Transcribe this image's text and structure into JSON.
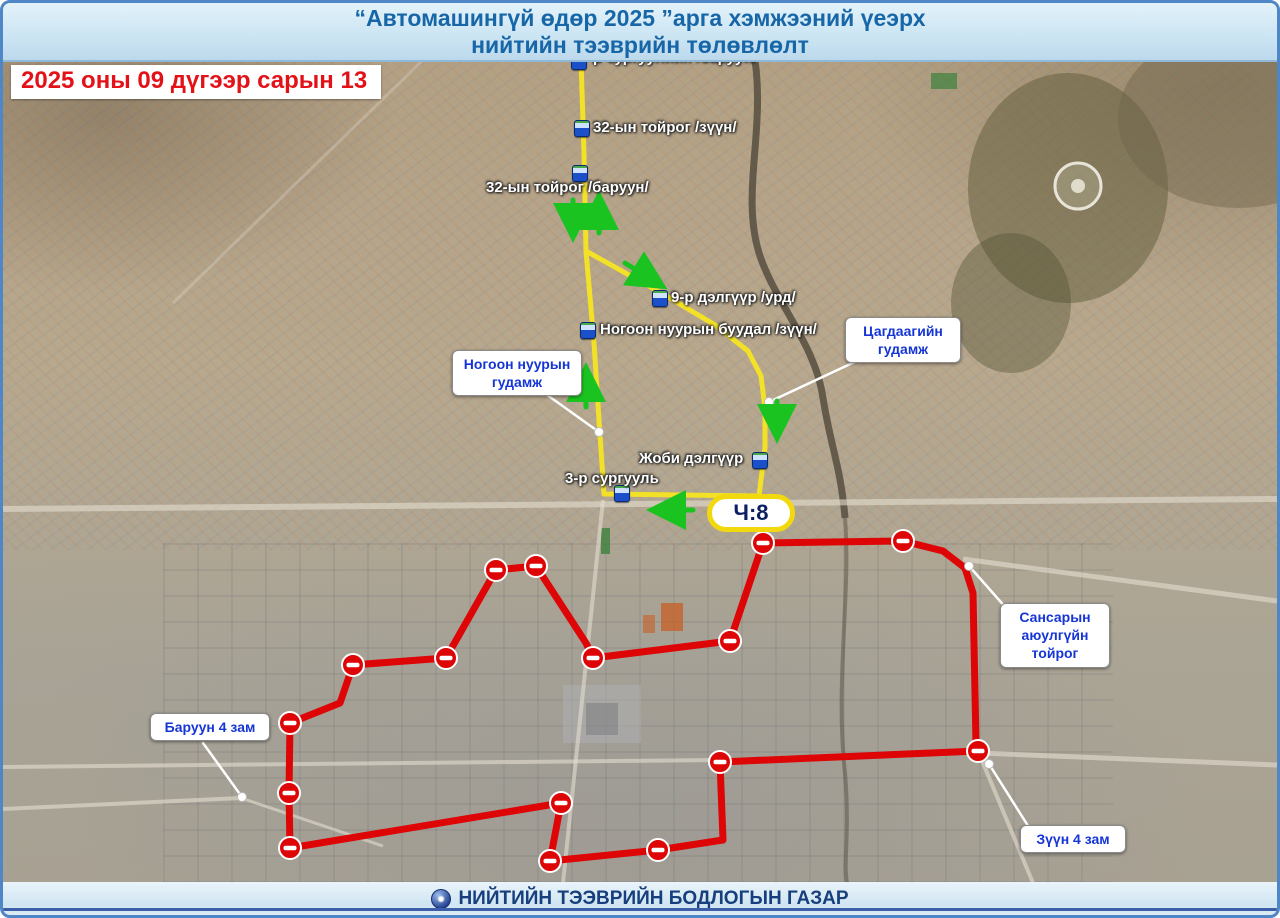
{
  "header": {
    "title_line1": "“Автомашингүй өдөр 2025 ”арга хэмжээний үеэрх",
    "title_line2": "нийтийн тээврийн төлөвлөлт"
  },
  "date_badge": "2025 оны 09 дүгээр сарын 13",
  "footer": {
    "org": "НИЙТИЙН ТЭЭВРИЙН БОДЛОГЫН ГАЗАР",
    "logo": "public-transport-authority-emblem"
  },
  "colors": {
    "yellow_route": "#f2e126",
    "red_route": "#dd0505",
    "arrow_green": "#1bc320",
    "callout_text": "#1535d6",
    "stop_label_text": "#ffffff",
    "header_text": "#1766a8",
    "date_text": "#e31219",
    "footer_text": "#173f7d",
    "badge_border": "#f2d90e",
    "badge_text": "#0b1f63"
  },
  "map": {
    "route_badge": {
      "text": "Ч:8"
    },
    "stops": [
      {
        "label": "-р сургуулийн /баруун/"
      },
      {
        "label": "32-ын тойрог /зүүн/"
      },
      {
        "label": "32-ын тойрог /баруун/"
      },
      {
        "label": "9-р дэлгүүр /урд/"
      },
      {
        "label": "Ногоон нуурын буудал /зүүн/"
      },
      {
        "label": "Жоби дэлгүүр"
      },
      {
        "label": "3-р сургууль"
      }
    ],
    "callouts": [
      {
        "id": "tsagdaagiin-gudamj",
        "lines": [
          "Цагдаагийн",
          "гудамж"
        ],
        "leader": [
          [
            858,
            356
          ],
          [
            766,
            399
          ]
        ]
      },
      {
        "id": "nogoon-nuuryn-gudamj",
        "lines": [
          "Ногоон нуурын",
          "гудамж"
        ],
        "leader": [
          [
            540,
            389
          ],
          [
            596,
            429
          ]
        ]
      },
      {
        "id": "sansaryn-toirog",
        "lines": [
          "Сансарын",
          "аюулгүйн",
          "тойрог"
        ],
        "leader": [
          [
            1004,
            606
          ],
          [
            966,
            563
          ]
        ]
      },
      {
        "id": "baruun-4-zam",
        "lines": [
          "Баруун 4 зам"
        ],
        "leader": [
          [
            200,
            740
          ],
          [
            239,
            794
          ]
        ]
      },
      {
        "id": "zuun-4-zam",
        "lines": [
          "Зүүн 4 зам"
        ],
        "leader": [
          [
            1027,
            826
          ],
          [
            986,
            761
          ]
        ]
      }
    ],
    "routes": {
      "yellow": {
        "name": "bus-route-Ч8",
        "paths": [
          [
            [
              578,
              57
            ],
            [
              581,
              150
            ],
            [
              583,
              248
            ],
            [
              591,
              340
            ],
            [
              597,
              432
            ],
            [
              601,
              491
            ],
            [
              756,
              493
            ]
          ],
          [
            [
              583,
              248
            ],
            [
              660,
              291
            ],
            [
              712,
              322
            ],
            [
              745,
              348
            ],
            [
              758,
              373
            ],
            [
              762,
              405
            ],
            [
              762,
              445
            ],
            [
              756,
              493
            ]
          ]
        ]
      },
      "red": {
        "name": "road-closure-perimeter",
        "points": [
          [
            493,
            567
          ],
          [
            533,
            563
          ],
          [
            583,
            640
          ],
          [
            590,
            655
          ],
          [
            727,
            638
          ],
          [
            760,
            540
          ],
          [
            900,
            538
          ],
          [
            940,
            548
          ],
          [
            962,
            565
          ],
          [
            970,
            590
          ],
          [
            973,
            740
          ],
          [
            975,
            748
          ],
          [
            717,
            759
          ],
          [
            720,
            837
          ],
          [
            655,
            847
          ],
          [
            547,
            858
          ],
          [
            558,
            800
          ],
          [
            287,
            845
          ],
          [
            286,
            790
          ],
          [
            287,
            720
          ],
          [
            337,
            700
          ],
          [
            350,
            662
          ],
          [
            443,
            655
          ]
        ],
        "signs": [
          [
            493,
            567
          ],
          [
            533,
            563
          ],
          [
            590,
            655
          ],
          [
            727,
            638
          ],
          [
            760,
            540
          ],
          [
            900,
            538
          ],
          [
            975,
            748
          ],
          [
            717,
            759
          ],
          [
            655,
            847
          ],
          [
            547,
            858
          ],
          [
            558,
            800
          ],
          [
            287,
            845
          ],
          [
            286,
            790
          ],
          [
            287,
            720
          ],
          [
            350,
            662
          ],
          [
            443,
            655
          ]
        ]
      }
    },
    "arrows": [
      [
        570,
        197,
        570,
        230
      ],
      [
        596,
        230,
        596,
        197
      ],
      [
        622,
        260,
        656,
        281
      ],
      [
        583,
        404,
        583,
        369
      ],
      [
        774,
        398,
        774,
        431
      ],
      [
        690,
        507,
        653,
        507
      ]
    ]
  }
}
